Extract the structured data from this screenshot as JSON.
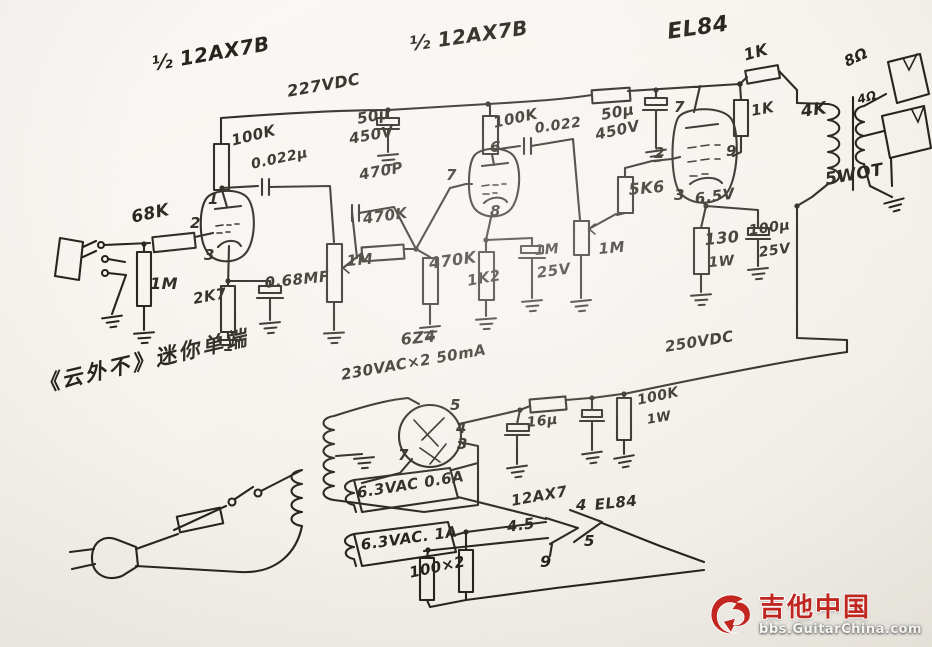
{
  "schematic": {
    "labels": [
      "½ 12AX7B",
      "½ 12AX7B",
      "EL84",
      "227VDC",
      "100K",
      "0.022μ",
      "50μ",
      "450V",
      "470P",
      "470K",
      "1M",
      "470K",
      "68K",
      "1M",
      "2K7",
      "0.68MF",
      "100K",
      "0.022",
      "50μ",
      "450V",
      "1K2",
      "1M",
      "25V",
      "1M",
      "5K6",
      "6.5V",
      "130",
      "1W",
      "100μ",
      "25V",
      "1K",
      "1K",
      "4K",
      "8Ω",
      "4Ω",
      "5WOT",
      "6Z4",
      "230VAC×2 50mA",
      "250VDC",
      "16μ",
      "100K",
      "1W",
      "6.3VAC 0.6A",
      "12AX7",
      "4.5",
      "4",
      "EL84",
      "5",
      "9",
      "6.3VAC. 1A",
      "100×2",
      "《云外不》迷你单端"
    ],
    "pins": [
      "1",
      "2",
      "3",
      "6",
      "7",
      "8",
      "7",
      "2",
      "9",
      "3",
      "5",
      "4",
      "3",
      "7"
    ]
  },
  "watermark": {
    "brand": "吉他中国",
    "site": "bbs.GuitarChina.com"
  }
}
